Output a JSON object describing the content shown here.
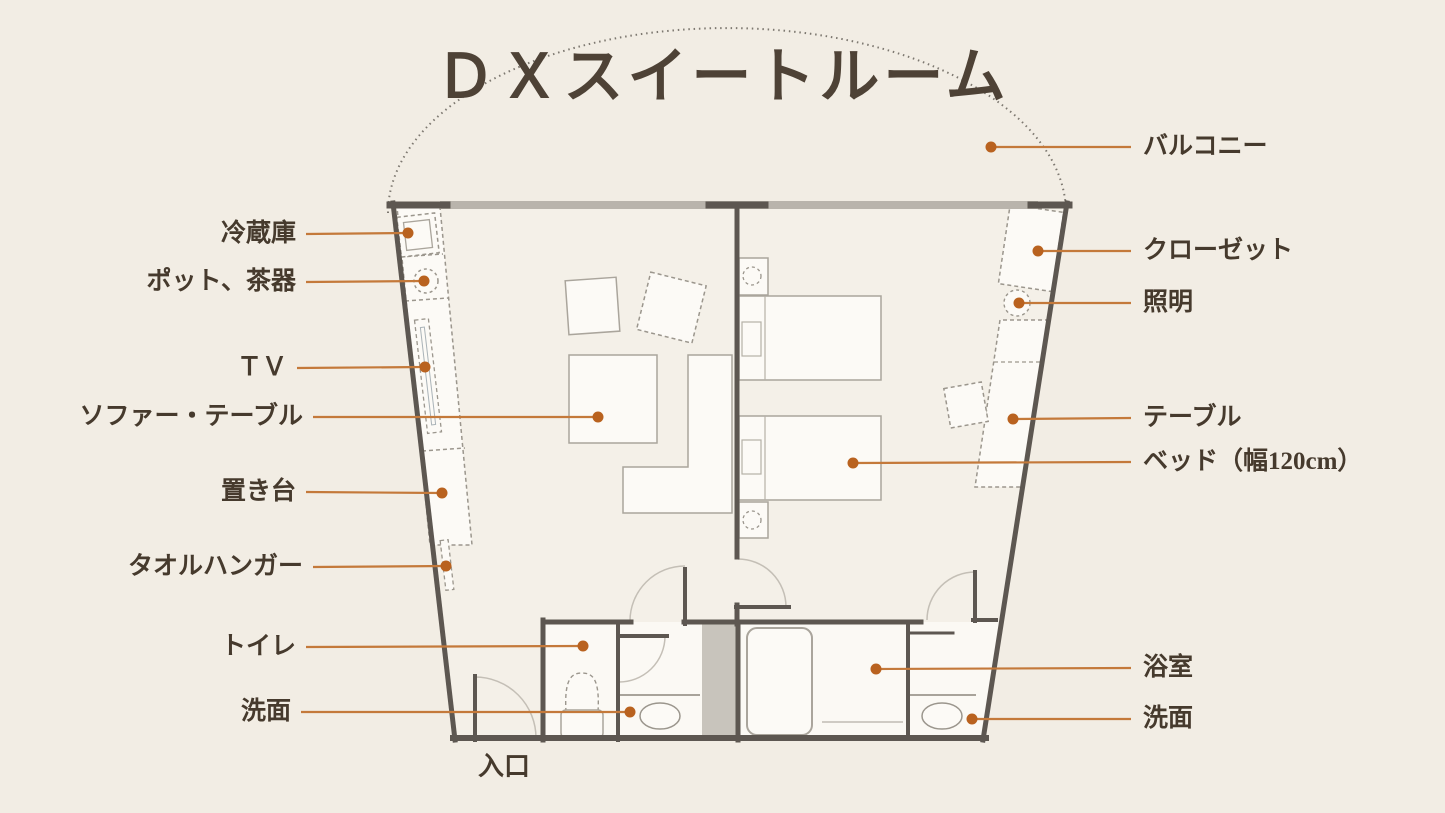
{
  "title": "ＤＸスイートルーム",
  "entrance": {
    "id": "entrance",
    "label": "入口",
    "x": 478,
    "y": 746
  },
  "colors": {
    "leader_line": "#c4793a",
    "leader_dot": "#b9621f",
    "text": "#463a2d"
  },
  "callouts": {
    "left": [
      {
        "id": "refrigerator",
        "label": "冷蔵庫",
        "tx": 306,
        "ty": 234,
        "dot": [
          408,
          233
        ]
      },
      {
        "id": "pot-tea-set",
        "label": "ポット、茶器",
        "tx": 306,
        "ty": 282,
        "dot": [
          424,
          281
        ]
      },
      {
        "id": "tv",
        "label": "ＴＶ",
        "tx": 297,
        "ty": 368,
        "dot": [
          425,
          367
        ]
      },
      {
        "id": "sofa-table",
        "label": "ソファー・テーブル",
        "tx": 313,
        "ty": 417,
        "dot": [
          598,
          417
        ]
      },
      {
        "id": "stand",
        "label": "置き台",
        "tx": 306,
        "ty": 492,
        "dot": [
          442,
          493
        ]
      },
      {
        "id": "towel-hanger",
        "label": "タオルハンガー",
        "tx": 313,
        "ty": 567,
        "dot": [
          446,
          566
        ]
      },
      {
        "id": "toilet",
        "label": "トイレ",
        "tx": 306,
        "ty": 647,
        "dot": [
          583,
          646
        ]
      },
      {
        "id": "washbasin-left",
        "label": "洗面",
        "tx": 301,
        "ty": 712,
        "dot": [
          630,
          712
        ]
      }
    ],
    "right": [
      {
        "id": "balcony",
        "label": "バルコニー",
        "tx": 1131,
        "ty": 147,
        "dot": [
          991,
          147
        ]
      },
      {
        "id": "closet",
        "label": "クローゼット",
        "tx": 1131,
        "ty": 251,
        "dot": [
          1038,
          251
        ]
      },
      {
        "id": "lighting",
        "label": "照明",
        "tx": 1131,
        "ty": 303,
        "dot": [
          1019,
          303
        ]
      },
      {
        "id": "table",
        "label": "テーブル",
        "tx": 1131,
        "ty": 418,
        "dot": [
          1013,
          419
        ]
      },
      {
        "id": "bed",
        "label": "ベッド（幅120cm）",
        "tx": 1131,
        "ty": 462,
        "dot": [
          853,
          463
        ]
      },
      {
        "id": "bathroom",
        "label": "浴室",
        "tx": 1131,
        "ty": 668,
        "dot": [
          876,
          669
        ]
      },
      {
        "id": "washbasin-right",
        "label": "洗面",
        "tx": 1131,
        "ty": 719,
        "dot": [
          972,
          719
        ]
      }
    ]
  }
}
